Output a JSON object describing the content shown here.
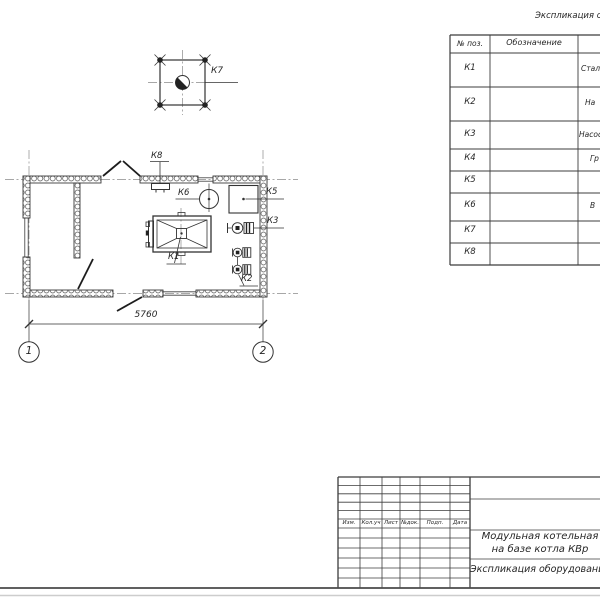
{
  "equipment_table": {
    "title": "Экспликация оборудования",
    "header": {
      "pos": "№ поз.",
      "designation": "Обозначение"
    },
    "rows": [
      {
        "pos": "К1",
        "designation": "",
        "name": "Стал"
      },
      {
        "pos": "К2",
        "designation": "",
        "name": "На"
      },
      {
        "pos": "К3",
        "designation": "",
        "name": "Насос"
      },
      {
        "pos": "К4",
        "designation": "",
        "name": "Гр"
      },
      {
        "pos": "К5",
        "designation": "",
        "name": ""
      },
      {
        "pos": "К6",
        "designation": "",
        "name": "В"
      },
      {
        "pos": "К7",
        "designation": "",
        "name": ""
      },
      {
        "pos": "К8",
        "designation": "",
        "name": ""
      }
    ]
  },
  "plan": {
    "labels": {
      "k1": "К1",
      "k2": "К2",
      "k3": "К3",
      "k5": "К5",
      "k6": "К6",
      "k7": "К7",
      "k8": "К8"
    },
    "dimension": "5760",
    "axis1": "1",
    "axis2": "2"
  },
  "titleblock": {
    "columns": [
      "Изм.",
      "Кол.уч",
      "Лист",
      "№док.",
      "Подп.",
      "Дата"
    ],
    "project_line1": "Модульная котельная",
    "project_line2": "на базе котла КВр",
    "sheet_title": "Экспликация оборудования"
  },
  "colors": {
    "line": "#3c3c3c",
    "centerline": "#8a8a8a",
    "frame": "#4a4a4a"
  }
}
